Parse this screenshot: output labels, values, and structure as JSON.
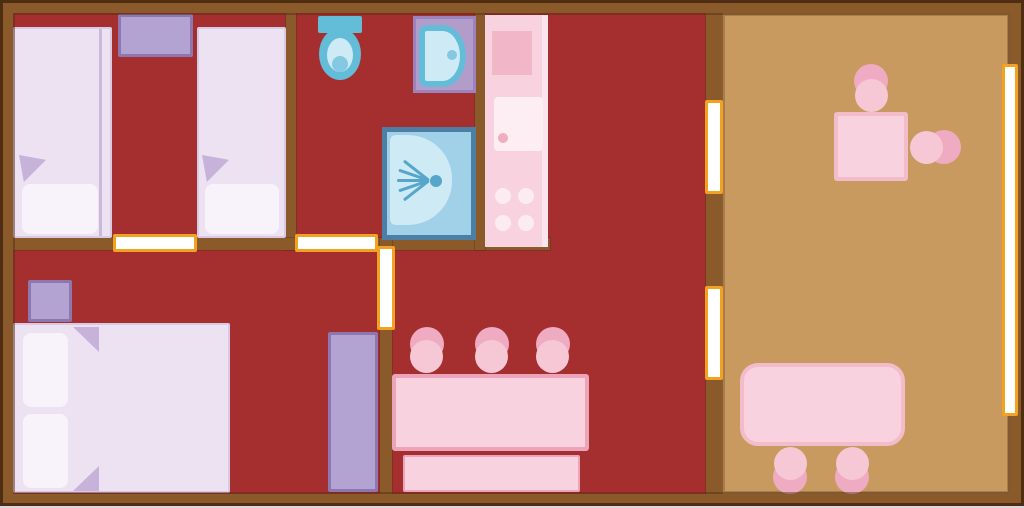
{
  "diagram": {
    "type": "floor-plan",
    "description": "lodge floor plan",
    "rooms": [
      {
        "name": "twin-bedroom",
        "furniture": [
          "single-bed",
          "single-bed",
          "nightstand"
        ]
      },
      {
        "name": "bathroom",
        "furniture": [
          "toilet",
          "washbasin",
          "shower"
        ]
      },
      {
        "name": "kitchen",
        "furniture": [
          "kitchenette-counter",
          "worktop",
          "sink-unit",
          "stove-4-burners"
        ]
      },
      {
        "name": "double-bedroom",
        "furniture": [
          "double-bed",
          "nightstand",
          "wardrobe"
        ]
      },
      {
        "name": "living-dining",
        "furniture": [
          "dining-table",
          "bench",
          "chair",
          "chair",
          "chair"
        ]
      },
      {
        "name": "terrace",
        "furniture": [
          "square-table",
          "chair",
          "chair",
          "rectangular-table",
          "chair",
          "chair"
        ]
      }
    ],
    "openings": {
      "doors": 3,
      "windows": 3
    }
  },
  "colors": {
    "floor_red": "#a52f2f",
    "wall_brown": "#8a5a2a",
    "wall_dark": "#4e2d13",
    "terrace_tan": "#c99a5f",
    "door_frame": "#f3a120",
    "door_fill": "#ffffff",
    "bed_lavender": "#ece2f2",
    "bed_edge": "#d9c9e5",
    "seam_lavender": "#cbb9dc",
    "pillow_white": "#f8f2fa",
    "fold_lavender": "#c7b2da",
    "purple_fill": "#b3a3d2",
    "purple_edge": "#8d77ae",
    "mat_fill": "#b19cca",
    "mat_edge": "#9d83bd",
    "fixture_blue": "#63bdd9",
    "fixture_light": "#cdeaf5",
    "fixture_mid": "#84c8e1",
    "shower_frame": "#4d7ea3",
    "shower_fill": "#a1d1e8",
    "spray_blue": "#56a5ca",
    "counter_pink": "#f8d2de",
    "counter_dark": "#f2b6c9",
    "counter_light": "#fbe4ed",
    "appliance_white": "#fdeef3",
    "burner_white": "#fcecf2",
    "accent_dot": "#f2abbf",
    "pink_fill": "#f8d2de",
    "pink_border": "#eba4ba",
    "tpink_border": "#f2bccb",
    "chair_light": "#f6c8d5",
    "chair_dark": "#efabc1",
    "edge_bottom": "#d9d6dc"
  }
}
